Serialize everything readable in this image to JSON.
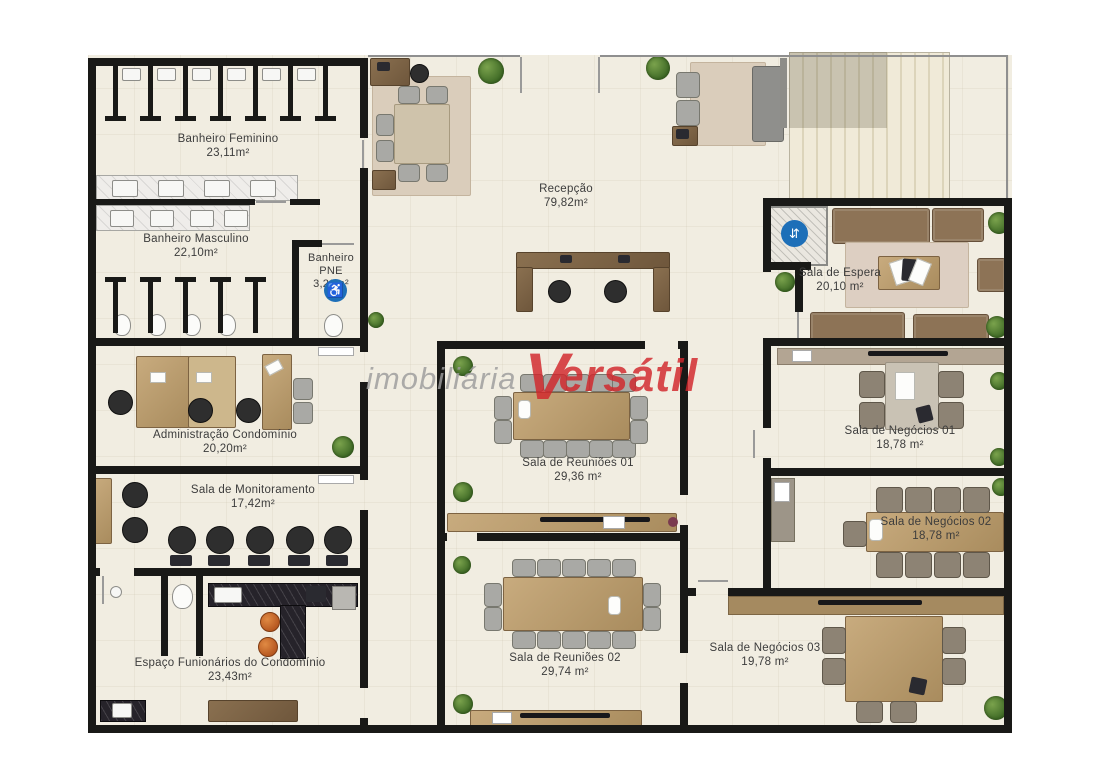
{
  "watermark": {
    "part1": "imobiliária",
    "part2": "V",
    "part3": "ersátil"
  },
  "icons": {
    "pne": "♿",
    "elevator": "⇵"
  },
  "colors": {
    "wall": "#191917",
    "floor": "#f1ede1",
    "wood": "#b59a6d",
    "wood_dark": "#8a7050",
    "watermark_gray": "#9c9c9c",
    "watermark_red": "#d2262b",
    "badge_blue": "#1d6fb8",
    "plant_green": "#4f7d2f",
    "sofa_brown": "#8d7356",
    "stool_orange": "#cb6a2c",
    "chair_gray": "#a9a9a5",
    "chair_black": "#2e2e2e",
    "counter_black": "#26232a"
  },
  "rooms": [
    {
      "id": "banheiro-feminino",
      "label": "Banheiro Feminino",
      "area": "23,11m²"
    },
    {
      "id": "banheiro-masculino",
      "label": "Banheiro Masculino",
      "area": "22,10m²"
    },
    {
      "id": "banheiro-pne",
      "label": "Banheiro",
      "label2": "PNE",
      "area": "3,20m²"
    },
    {
      "id": "recepcao",
      "label": "Recepção",
      "area": "79,82m²"
    },
    {
      "id": "sala-de-espera",
      "label": "Sala de Espera",
      "area": "20,10 m²"
    },
    {
      "id": "administracao-condominio",
      "label": "Administração Condomínio",
      "area": "20,20m²"
    },
    {
      "id": "sala-de-monitoramento",
      "label": "Sala de Monitoramento",
      "area": "17,42m²"
    },
    {
      "id": "sala-de-reunioes-01",
      "label": "Sala de Reuniões 01",
      "area": "29,36 m²"
    },
    {
      "id": "sala-de-reunioes-02",
      "label": "Sala de Reuniões 02",
      "area": "29,74 m²"
    },
    {
      "id": "sala-de-negocios-01",
      "label": "Sala de Negócios 01",
      "area": "18,78 m²"
    },
    {
      "id": "sala-de-negocios-02",
      "label": "Sala de Negócios 02",
      "area": "18,78 m²"
    },
    {
      "id": "sala-de-negocios-03",
      "label": "Sala de Negócios 03",
      "area": "19,78 m²"
    },
    {
      "id": "espaco-funcionarios",
      "label": "Espaço Funionários do Condomínio",
      "area": "23,43m²"
    }
  ]
}
